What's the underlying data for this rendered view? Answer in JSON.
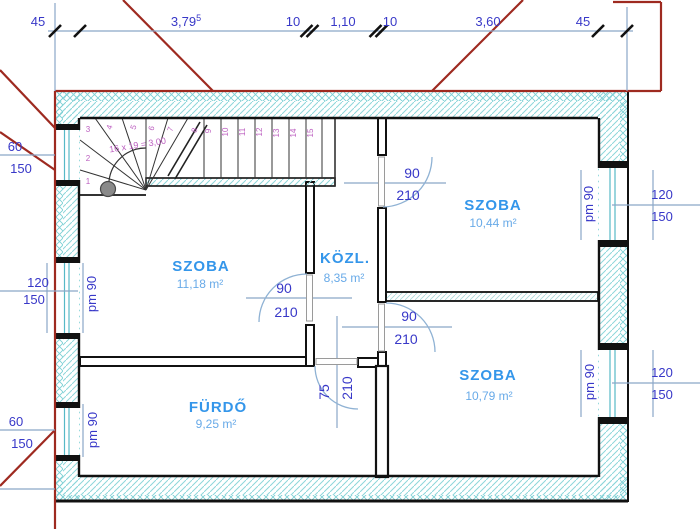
{
  "rooms": {
    "szoba_left": {
      "name": "SZOBA",
      "area": "11,18 m²"
    },
    "kozl": {
      "name": "KÖZL.",
      "area": "8,35 m²"
    },
    "szoba_top_right": {
      "name": "SZOBA",
      "area": "10,44 m²"
    },
    "szoba_bottom_right": {
      "name": "SZOBA",
      "area": "10,79 m²"
    },
    "furdo": {
      "name": "FÜRDŐ",
      "area": "9,25 m²"
    }
  },
  "dimensions": {
    "top": {
      "d1": "45",
      "d2_base": "3,79",
      "d2_sup": "5",
      "d3": "10",
      "d4": "1,10",
      "d5": "10",
      "d6": "3,60",
      "d7": "45"
    },
    "left": {
      "w1_width": "60",
      "w1_height": "150",
      "w2_width": "120",
      "w2_height": "150",
      "w2_parapet": "pm 90",
      "w3_width": "60",
      "w3_height": "150",
      "w3_parapet": "pm 90"
    },
    "right": {
      "w4_width": "120",
      "w4_height": "150",
      "w4_parapet": "pm 90",
      "w5_width": "120",
      "w5_height": "150",
      "w5_parapet": "pm 90"
    }
  },
  "doors": {
    "top_right": {
      "width": "90",
      "height": "210"
    },
    "left": {
      "width": "90",
      "height": "210"
    },
    "bottom_right": {
      "width": "90",
      "height": "210"
    },
    "bathroom": {
      "width": "75",
      "height": "210"
    }
  },
  "stairs": {
    "formula": "16 x 19 = 3,00",
    "numbers": [
      "1",
      "2",
      "3",
      "4",
      "5",
      "6",
      "7",
      "8",
      "9",
      "10",
      "11",
      "12",
      "13",
      "14",
      "15"
    ]
  },
  "colors": {
    "roof_line": "#9e2a20",
    "wall_hatch": "#84d2d6",
    "dimension_text": "#3838c8",
    "dimension_line": "#8aa6c8",
    "room_label": "#3496ea",
    "stair_label": "#bc5fc0"
  }
}
